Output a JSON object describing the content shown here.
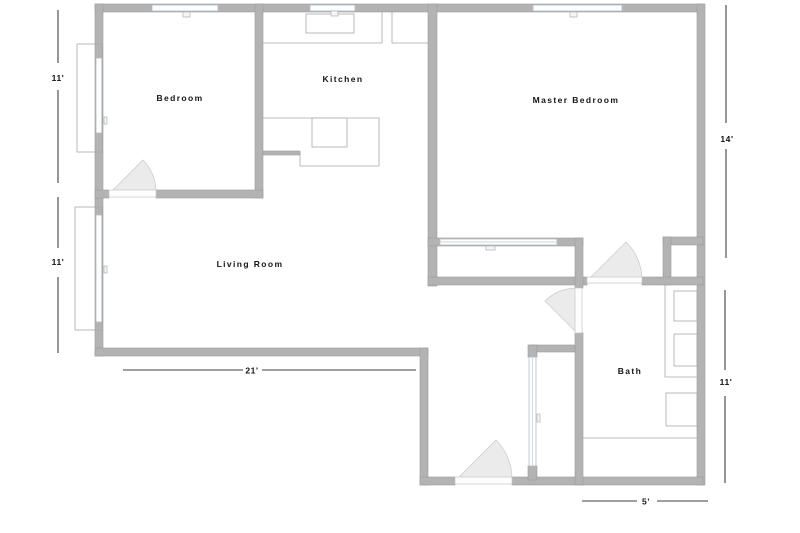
{
  "title": "Apartment floor plan",
  "rooms": [
    {
      "id": "bedroom",
      "label": "Bedroom"
    },
    {
      "id": "kitchen",
      "label": "Kitchen"
    },
    {
      "id": "master-bedroom",
      "label": "Master Bedroom"
    },
    {
      "id": "living-room",
      "label": "Living Room"
    },
    {
      "id": "bath",
      "label": "Bath"
    }
  ],
  "dimensions": [
    {
      "id": "left-upper",
      "label": "11'"
    },
    {
      "id": "left-lower",
      "label": "11'"
    },
    {
      "id": "right-upper",
      "label": "14'"
    },
    {
      "id": "right-lower",
      "label": "11'"
    },
    {
      "id": "bottom-left",
      "label": "21'"
    },
    {
      "id": "bottom-right",
      "label": "5'"
    }
  ],
  "colors": {
    "background": "#ffffff",
    "wall": "#b3b3b3",
    "wall_edge": "#9b9b9b",
    "window": "#fbfdfe",
    "door_sweep": "#ebebeb",
    "fixture_line": "#a9a9a9",
    "dimension_line": "#3f3f3f",
    "label_text": "#141414"
  }
}
